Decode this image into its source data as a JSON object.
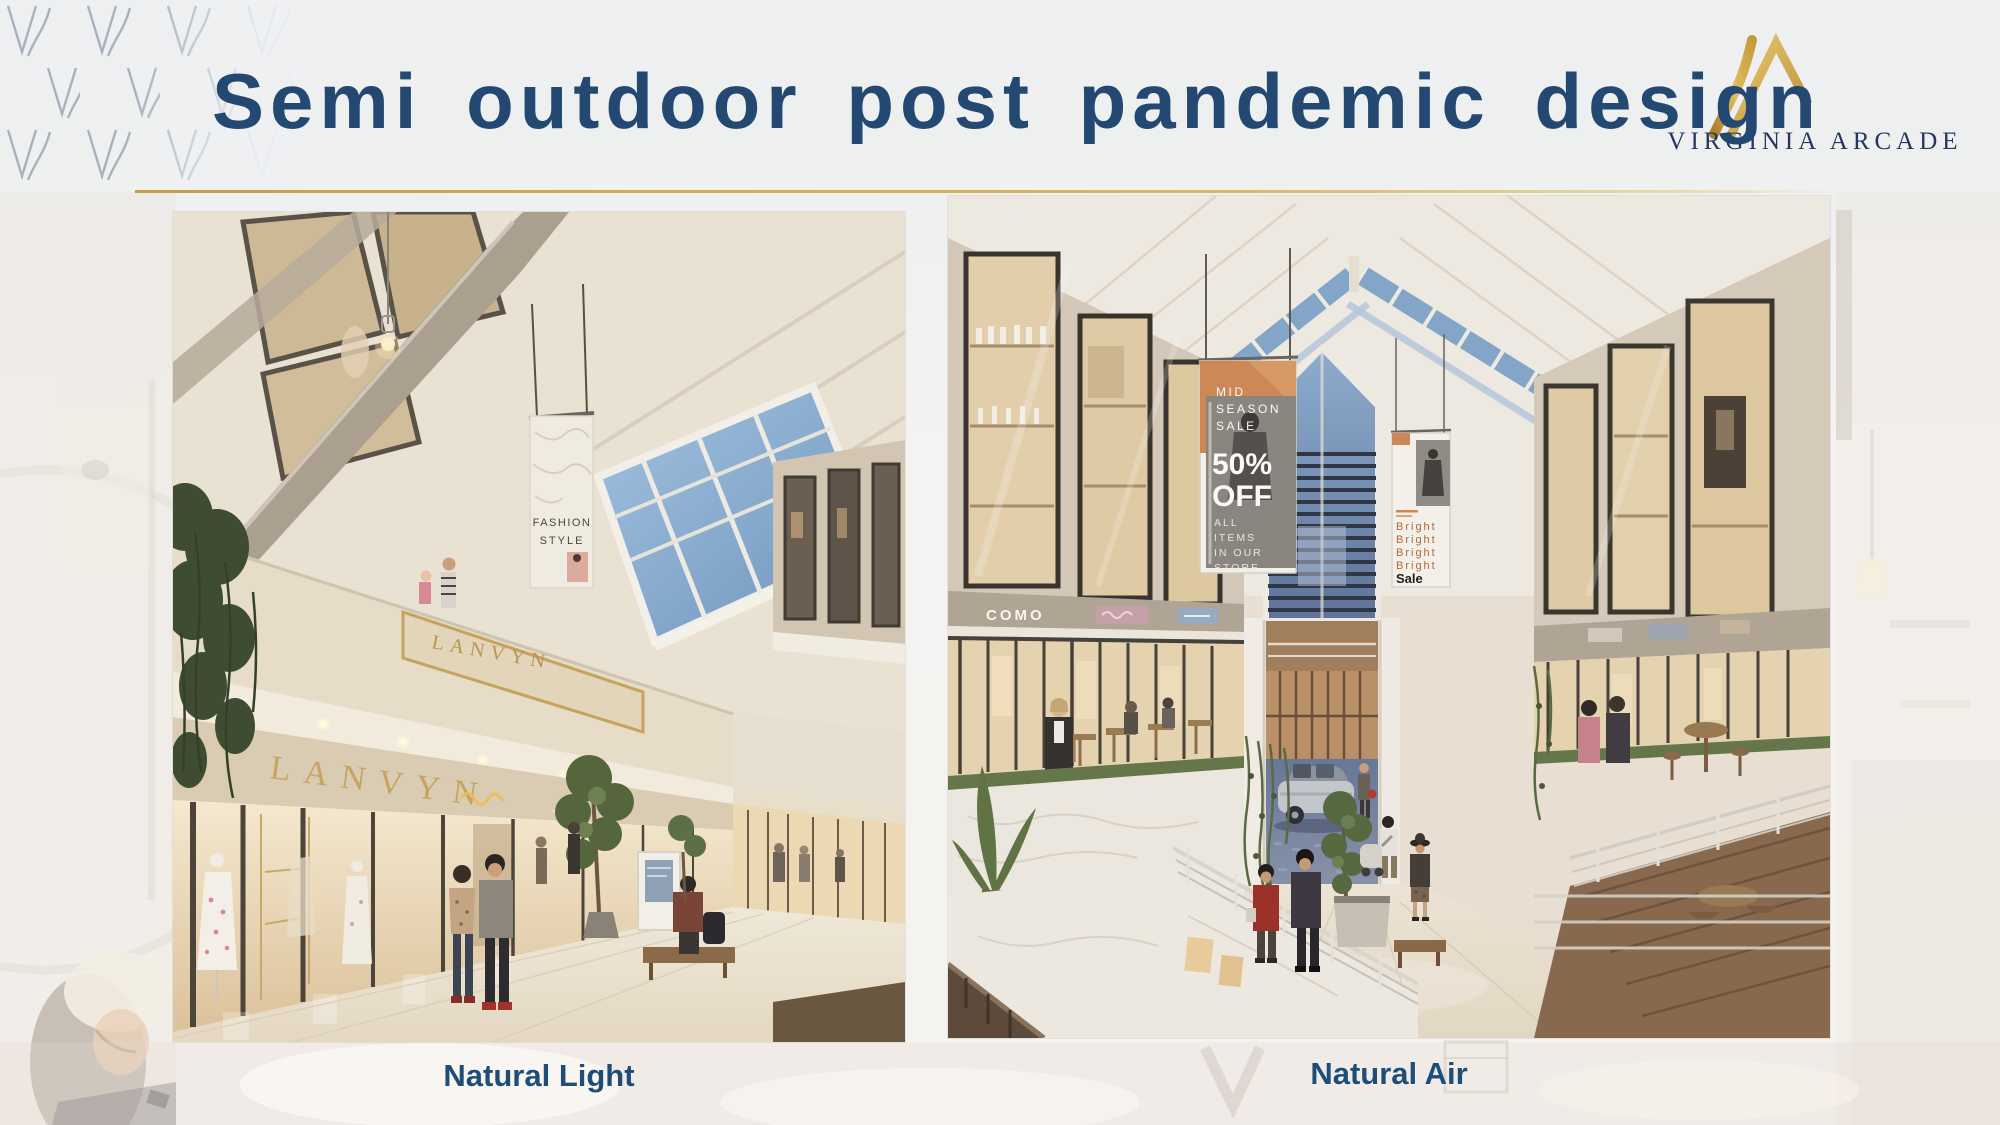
{
  "slide": {
    "title": "Semi outdoor post pandemic design",
    "logo": {
      "name": "VIRGINIA ARCADE"
    }
  },
  "captions": {
    "left": "Natural Light",
    "right": "Natural Air"
  },
  "left_photo": {
    "fascia_sign": "LANVYN",
    "store_sign": "LANVYN",
    "banner": {
      "line1": "FASHION",
      "line2": "STYLE"
    }
  },
  "right_photo": {
    "shop_sign": "COMO",
    "sale_banner": {
      "top": [
        "MID",
        "SEASON",
        "SALE"
      ],
      "big": [
        "50%",
        "OFF"
      ],
      "bottom": [
        "ALL",
        "ITEMS",
        "IN OUR",
        "STORE"
      ]
    },
    "bright_banner": {
      "lines": [
        "Bright",
        "Bright",
        "Bright",
        "Bright"
      ],
      "footer": "Sale"
    }
  },
  "colors": {
    "title_navy": "#234871",
    "caption_navy": "#1e4d78",
    "gold": "#c59c48",
    "sky_blue": "#7fa3c8",
    "wall_cream": "#e7dfd0"
  }
}
